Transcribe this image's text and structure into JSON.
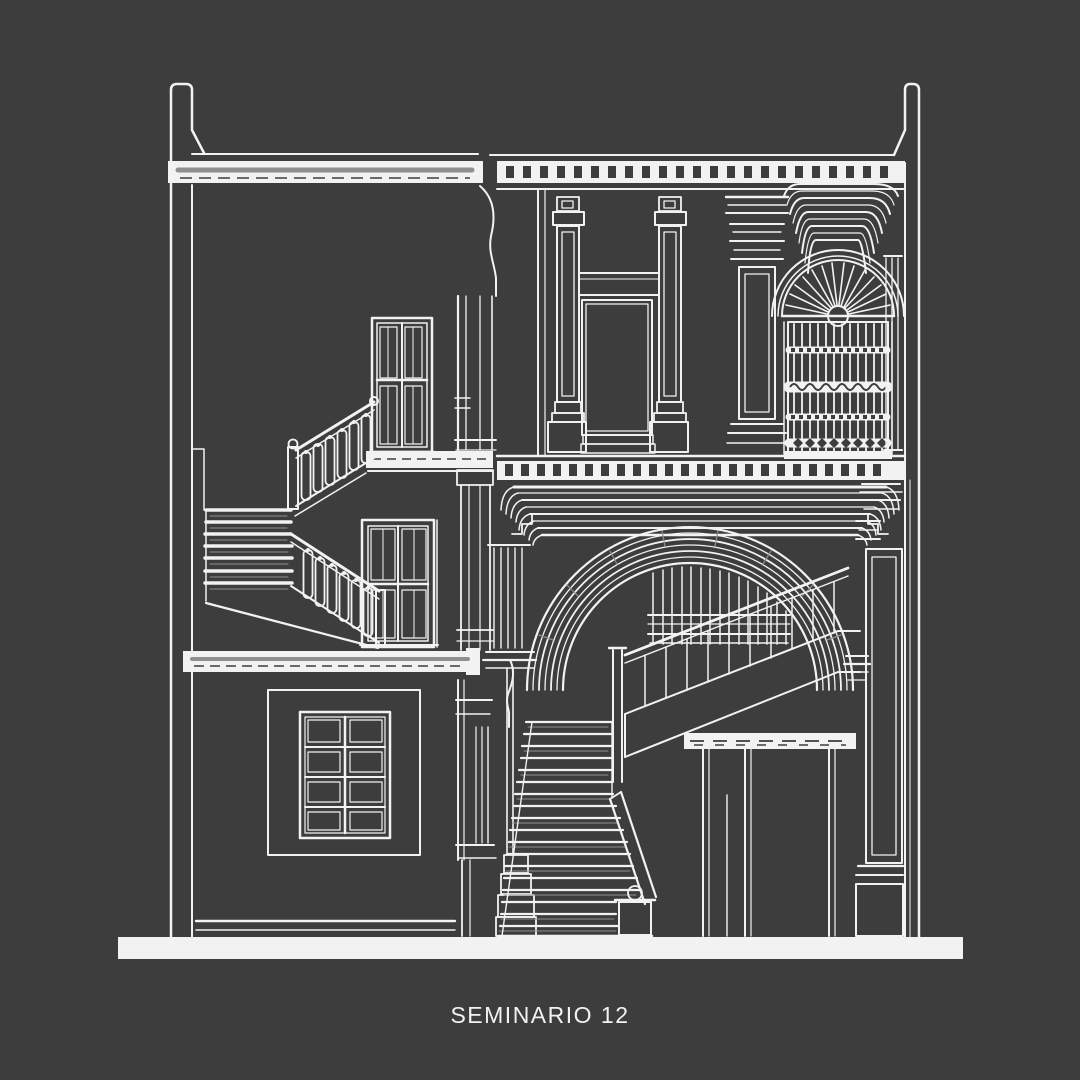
{
  "colors": {
    "background": "#3d3d3d",
    "ink": "#f2f2f2",
    "shade": "#8f8f8f"
  },
  "caption": {
    "text": "SEMINARIO 12"
  },
  "drawing": {
    "kind": "architectural-cross-section-drawing",
    "style": "white line art on dark gray",
    "features": [
      "left and right cut walls",
      "dentil cornices",
      "pilaster composition with panels",
      "fanlight with radiating spokes over iron window grille",
      "great semicircular multi-ring arch on pier",
      "interior staircase with balustrade inside arch",
      "upper and lower french doors with stair balustrades",
      "eight-pane window",
      "frontal stair flight with newel post",
      "ground line"
    ]
  }
}
